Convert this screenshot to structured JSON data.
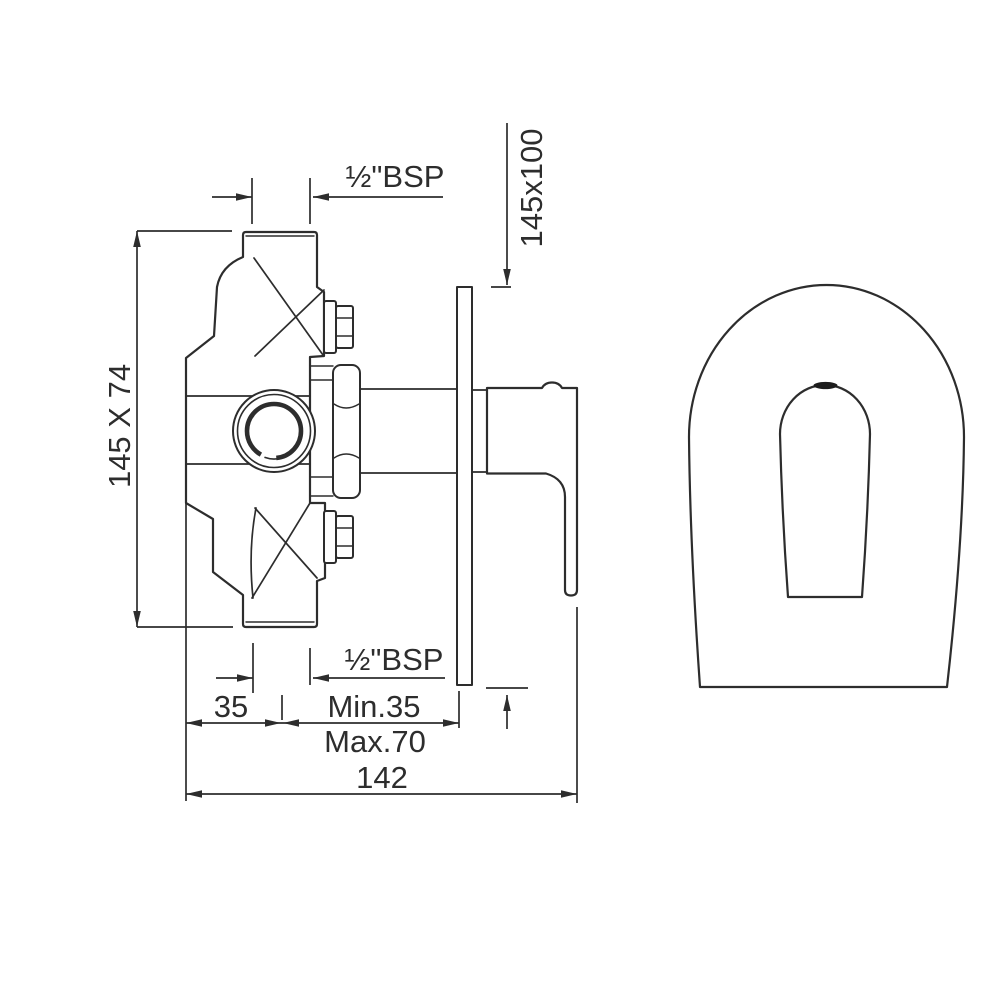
{
  "colors": {
    "background": "#ffffff",
    "line": "#2d2d2d",
    "text": "#2d2d2d"
  },
  "labels": {
    "top_thread": "½\"BSP",
    "plate_size": "145x100",
    "body_size": "145 X 74",
    "bottom_thread": "½\"BSP",
    "offset_35": "35",
    "wall_min": "Min.35",
    "wall_max": "Max.70",
    "total_depth": "142"
  }
}
